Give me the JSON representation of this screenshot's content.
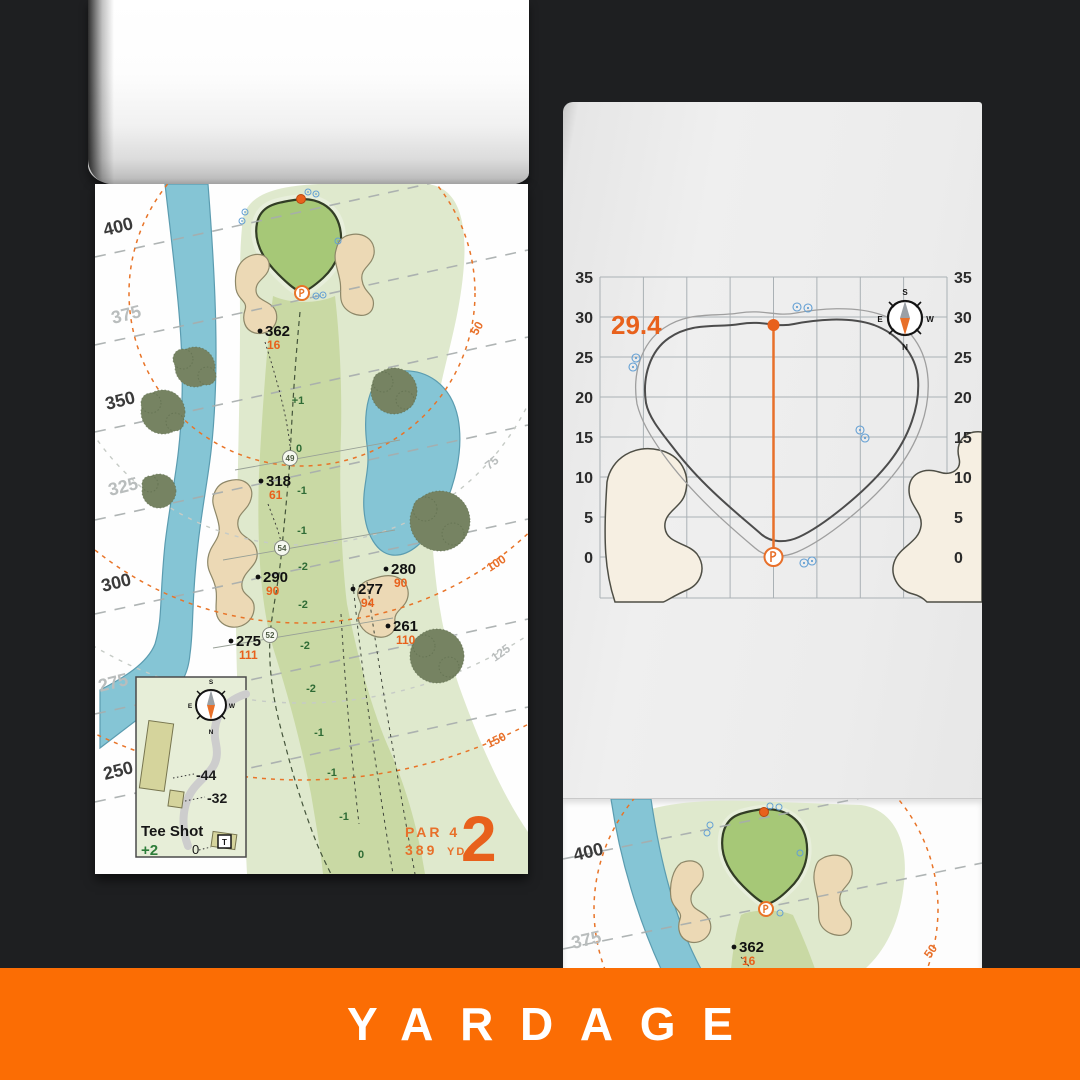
{
  "banner": {
    "label": "YARDAGE",
    "bg": "#fb6d04"
  },
  "left_page": {
    "hole_number": "2",
    "par_label": "PAR 4",
    "yards_value": "389",
    "yards_unit": "YD",
    "side_yardages": [
      "400",
      "375",
      "350",
      "325",
      "300",
      "275",
      "250"
    ],
    "range_arcs": [
      "50",
      "75",
      "100",
      "125",
      "150"
    ],
    "markers": [
      {
        "yards": "362",
        "alt": "16"
      },
      {
        "yards": "318",
        "alt": "61"
      },
      {
        "yards": "290",
        "alt": "90"
      },
      {
        "yards": "275",
        "alt": "111"
      },
      {
        "yards": "280",
        "alt": "90"
      },
      {
        "yards": "277",
        "alt": "94"
      },
      {
        "yards": "261",
        "alt": "110"
      }
    ],
    "slopes": [
      "+1",
      "0",
      "-1",
      "-1",
      "-2",
      "-2",
      "-2",
      "-2",
      "-1",
      "-1",
      "-1",
      "0"
    ],
    "circled": [
      "49",
      "54",
      "52"
    ],
    "compass": {
      "n": "N",
      "s": "S",
      "e": "E",
      "w": "W"
    },
    "tee_inset": {
      "title": "Tee Shot",
      "relative": "+2",
      "zero": "0",
      "tee_letter": "T",
      "depth_labels": [
        "-44",
        "-32"
      ]
    }
  },
  "right_page": {
    "depth_value": "29.4",
    "ticks": [
      "35",
      "30",
      "25",
      "20",
      "15",
      "10",
      "5",
      "0"
    ],
    "compass": {
      "n": "N",
      "s": "S",
      "e": "E",
      "w": "W"
    }
  },
  "bottom_page": {
    "side_yardages": [
      "400",
      "375"
    ],
    "marker": {
      "yards": "362",
      "alt": "16"
    },
    "arc_label": "50"
  },
  "colors": {
    "accent_orange": "#e8611c",
    "banner_orange": "#fb6d04",
    "water_blue": "#85c5d5",
    "sand": "#ecd9b5",
    "green_surface": "#a6c877",
    "fairway": "#c9d9a4",
    "slope_green": "#2f6b35",
    "sprinkler_blue": "#64a0d4"
  }
}
